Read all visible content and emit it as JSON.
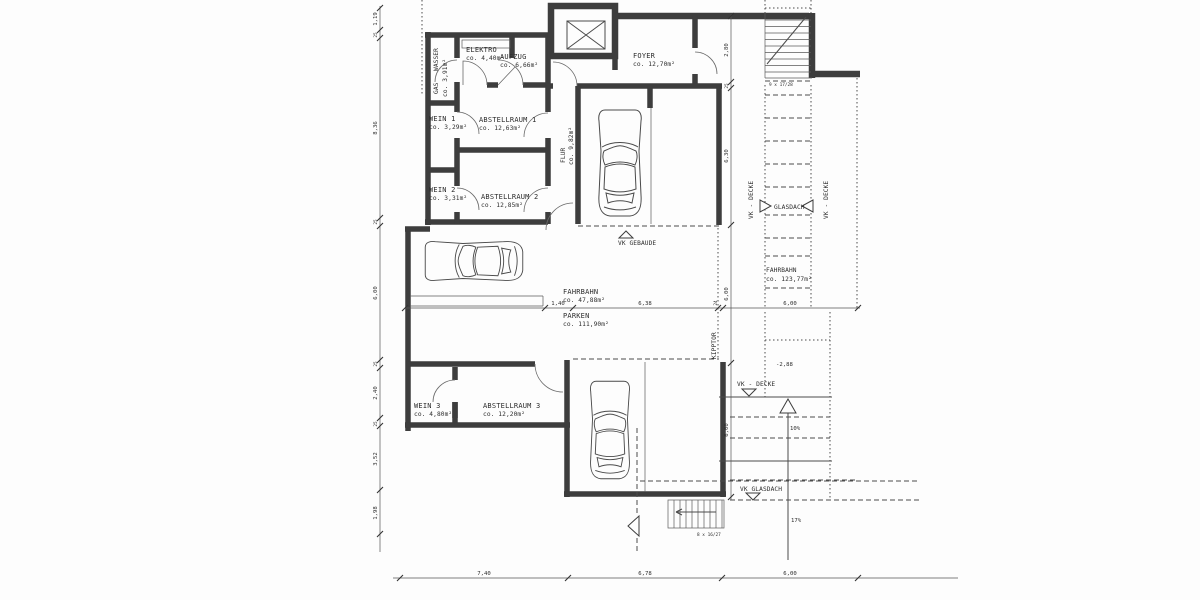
{
  "rooms": {
    "wasser_gas": {
      "line1": "WASSER",
      "line2": "GAS",
      "area": "co. 3,91m²"
    },
    "elektro": {
      "name": "ELEKTRO",
      "area": "co. 4,40m²"
    },
    "aufzug": {
      "name": "AUFZUG",
      "area": "co. 6,66m²"
    },
    "foyer": {
      "name": "FOYER",
      "area": "co. 12,70m²"
    },
    "wein1": {
      "name": "WEIN 1",
      "area": "co. 3,29m²"
    },
    "abstellraum1": {
      "name": "ABSTELLRAUM 1",
      "area": "co. 12,63m²"
    },
    "wein2": {
      "name": "WEIN 2",
      "area": "co. 3,31m²"
    },
    "abstellraum2": {
      "name": "ABSTELLRAUM 2",
      "area": "co. 12,85m²"
    },
    "wein3": {
      "name": "WEIN 3",
      "area": "co. 4,80m²"
    },
    "abstellraum3": {
      "name": "ABSTELLRAUM 3",
      "area": "co. 12,20m²"
    },
    "flur": {
      "name": "FLUR",
      "area": "co. 9,82m²"
    },
    "fahrbahn_garage": {
      "name": "FAHRBAHN",
      "area": "co. 47,88m²"
    },
    "parken": {
      "name": "PARKEN",
      "area": "co. 111,90m²"
    },
    "fahrbahn_rampe": {
      "name": "FAHRBAHN",
      "area": "co. 123,77m²"
    }
  },
  "annotations": {
    "vk_gebaeude": "VK GEBAUDE",
    "vk_decke": "VK - DECKE",
    "glasdach": "GLASDACH",
    "kipptor": "KIPPTOR",
    "vk_glasdach": "VK GLASDACH",
    "slope_upper": "10%",
    "slope_lower": "17%",
    "level": "-2,88",
    "stairs_top_note": "9 x 17/28",
    "stairs_bottom_note": "8 x 16/27"
  },
  "dims": {
    "left": [
      "1,19",
      "25",
      "8,36",
      "25",
      "6,00",
      "25",
      "2,40",
      "25",
      "3,52",
      "1,98"
    ],
    "right": [
      "2,80",
      "25",
      "6,30",
      "6,00",
      "6,00"
    ],
    "middle": [
      "1,40",
      "6,38",
      "24",
      "6,00"
    ],
    "bottom": [
      "7,40",
      "6,78",
      "6,00"
    ]
  },
  "colors": {
    "wall": "#3d3d3d",
    "line": "#4a4a4a",
    "paper": "#fdfdfd"
  }
}
